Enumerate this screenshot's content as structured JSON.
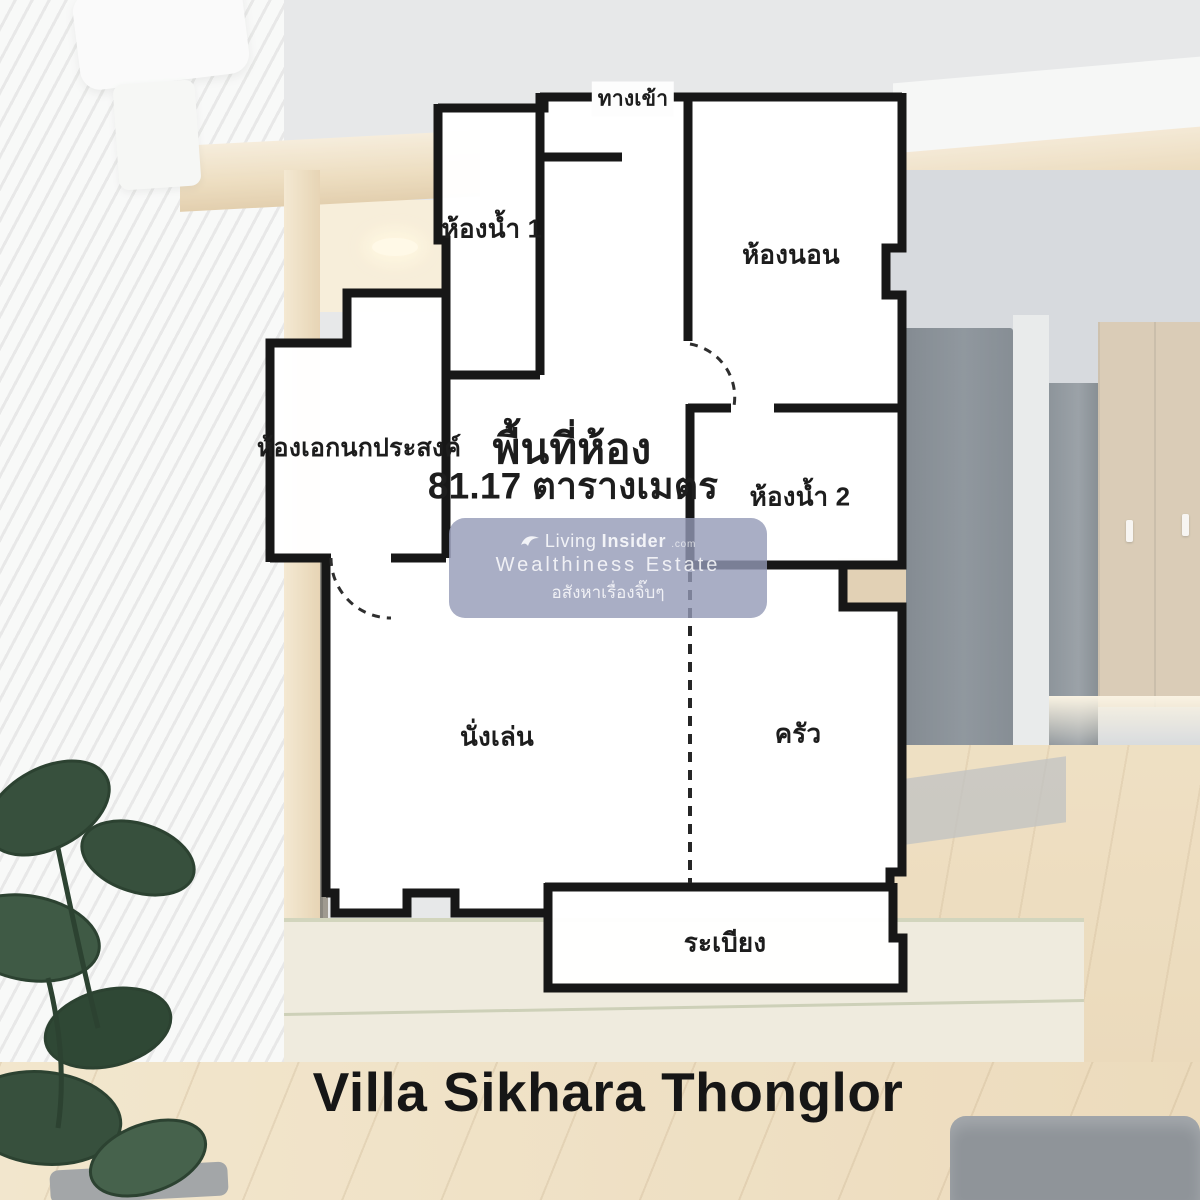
{
  "project": {
    "title": "Villa Sikhara Thonglor"
  },
  "floor_plan": {
    "area_title": "พื้นที่ห้อง",
    "area_detail": "81.17 ตารางเมตร",
    "area_value": "81.17",
    "area_unit": "ตารางเมตร",
    "rooms": [
      {
        "id": "entrance",
        "label": "ทางเข้า"
      },
      {
        "id": "bathroom-1",
        "label": "ห้องน้ำ 1"
      },
      {
        "id": "bedroom",
        "label": "ห้องนอน"
      },
      {
        "id": "multipurpose-room",
        "label": "ห้องเอกนกประสงค์"
      },
      {
        "id": "bathroom-2",
        "label": "ห้องน้ำ 2"
      },
      {
        "id": "living-room",
        "label": "นั่งเล่น"
      },
      {
        "id": "kitchen",
        "label": "ครัว"
      },
      {
        "id": "balcony",
        "label": "ระเบียง"
      }
    ]
  },
  "watermark": {
    "brand_prefix": "Living",
    "brand_suffix": "Insider",
    "brand_domain": ".com",
    "line2": "Wealthiness Estate",
    "line3": "อสังหาเรื่องจิ๊บๆ"
  },
  "colors": {
    "wall": "#171717",
    "room_fill": "#ffffff",
    "watermark_bg": "#939ab6",
    "title": "#161616"
  }
}
